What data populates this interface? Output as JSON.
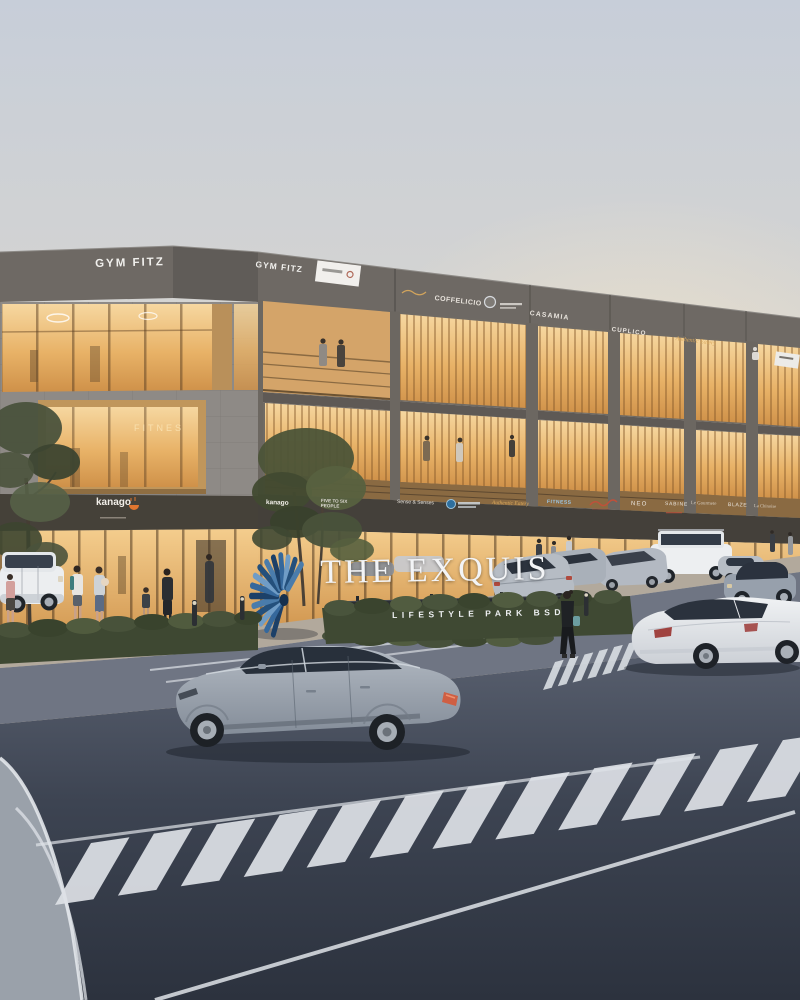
{
  "scene": {
    "title": "The Exquis Lifestyle Park BSD",
    "description": "Dusk architectural rendering of a three-storey lifestyle retail strip with warm lit shopfronts, balconies, parked cars, pedestrians, a blue shell sculpture, a monument sign and a roundabout road with zebra crossings.",
    "time_of_day": "dusk"
  },
  "monument": {
    "title": "THE EXQUIS",
    "subtitle": "LIFESTYLE PARK BSD"
  },
  "building": {
    "roof_signs": [
      {
        "label": "GYM FITZ"
      },
      {
        "label": "GYM FITZ"
      }
    ],
    "upper_signs": [
      {
        "label": "COFFELICIO"
      },
      {
        "label": "CASAMIA"
      },
      {
        "label": "CUPLICO"
      },
      {
        "label": "Authentic Eatery"
      }
    ],
    "ground_signs": [
      {
        "label": "kanago"
      },
      {
        "label": "kanago"
      },
      {
        "label": "FIVE TO SIX PEOPLE"
      },
      {
        "label": "Sense & Senses"
      },
      {
        "label": "Authentic Eatery"
      },
      {
        "label": "FITNESS"
      },
      {
        "label": "NEO"
      },
      {
        "label": "SABINE"
      },
      {
        "label": "Le Gourmete"
      },
      {
        "label": "BLAZE"
      },
      {
        "label": "La Chinoise"
      }
    ],
    "window_text": "FITNES"
  },
  "colors": {
    "sky_top": "#c7ced9",
    "sky_warm": "#f6e4c4",
    "facade_dark": "#6e6964",
    "stone": "#8e8a86",
    "window_glow": "#e8b267",
    "fascia": "#44403a",
    "road": "#3d4452",
    "hedge": "#3f4933",
    "sculpture_blue": "#35689c",
    "sign_wall": "#2b2e32",
    "marking_white": "#e3e7eb"
  }
}
